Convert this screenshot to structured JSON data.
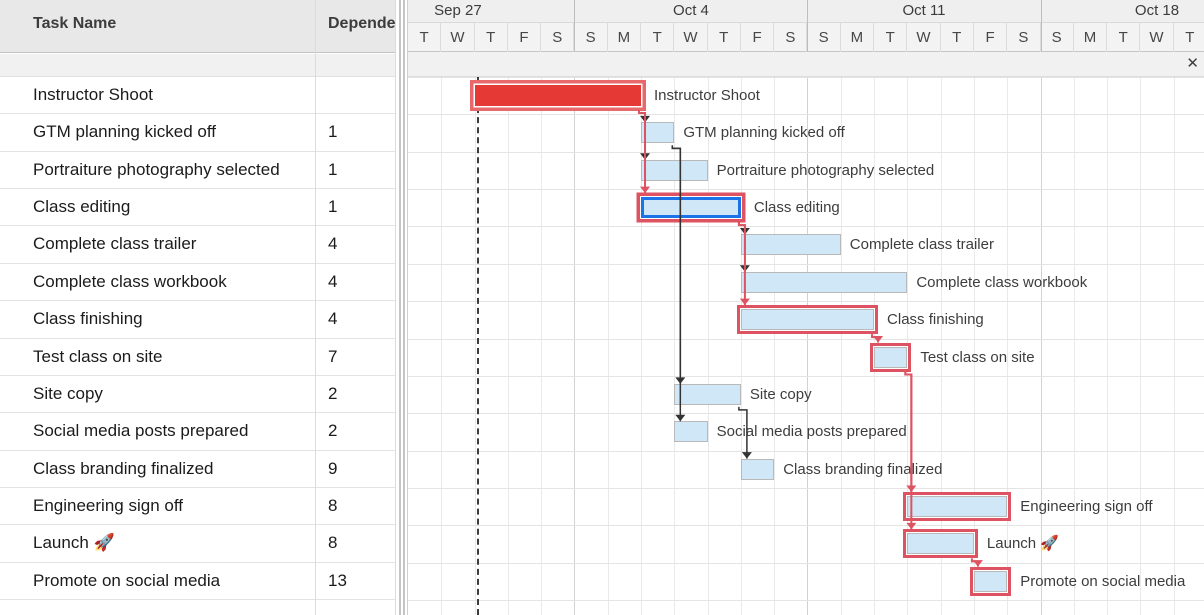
{
  "header": {
    "task_name_col": "Task Name",
    "dependencies_col": "Dependencies"
  },
  "timeline": {
    "weeks": [
      {
        "label": "Sep 27",
        "start_day": 0,
        "end_day": 5,
        "clipped": "left"
      },
      {
        "label": "Oct 4",
        "start_day": 5,
        "end_day": 12,
        "clipped": "none"
      },
      {
        "label": "Oct 11",
        "start_day": 12,
        "end_day": 19,
        "clipped": "none"
      },
      {
        "label": "Oct 18",
        "start_day": 19,
        "end_day": 24,
        "clipped": "right"
      }
    ],
    "day_letters": [
      "T",
      "W",
      "T",
      "F",
      "S",
      "S",
      "M",
      "T",
      "W",
      "T",
      "F",
      "S",
      "S",
      "M",
      "T",
      "W",
      "T",
      "F",
      "S",
      "S",
      "M",
      "T",
      "W",
      "T"
    ],
    "today_day_index": 2
  },
  "tasks": [
    {
      "id": 1,
      "name": "Instructor Shoot",
      "dependency": "",
      "start_day": 2,
      "duration_days": 5,
      "critical": true,
      "selected": false,
      "fill": "red"
    },
    {
      "id": 2,
      "name": "GTM planning kicked off",
      "dependency": "1",
      "start_day": 7,
      "duration_days": 1,
      "critical": false,
      "selected": false,
      "fill": "blue"
    },
    {
      "id": 3,
      "name": "Portraiture photography selected",
      "dependency": "1",
      "start_day": 7,
      "duration_days": 2,
      "critical": false,
      "selected": false,
      "fill": "blue"
    },
    {
      "id": 4,
      "name": "Class editing",
      "dependency": "1",
      "start_day": 7,
      "duration_days": 3,
      "critical": true,
      "selected": true,
      "fill": "blue"
    },
    {
      "id": 5,
      "name": "Complete class trailer",
      "dependency": "4",
      "start_day": 10,
      "duration_days": 3,
      "critical": false,
      "selected": false,
      "fill": "blue"
    },
    {
      "id": 6,
      "name": "Complete class workbook",
      "dependency": "4",
      "start_day": 10,
      "duration_days": 5,
      "critical": false,
      "selected": false,
      "fill": "blue"
    },
    {
      "id": 7,
      "name": "Class finishing",
      "dependency": "4",
      "start_day": 10,
      "duration_days": 4,
      "critical": true,
      "selected": false,
      "fill": "blue"
    },
    {
      "id": 8,
      "name": "Test class on site",
      "dependency": "7",
      "start_day": 14,
      "duration_days": 1,
      "critical": true,
      "selected": false,
      "fill": "blue"
    },
    {
      "id": 9,
      "name": "Site copy",
      "dependency": "2",
      "start_day": 8,
      "duration_days": 2,
      "critical": false,
      "selected": false,
      "fill": "blue"
    },
    {
      "id": 10,
      "name": "Social media posts prepared",
      "dependency": "2",
      "start_day": 8,
      "duration_days": 1,
      "critical": false,
      "selected": false,
      "fill": "blue"
    },
    {
      "id": 11,
      "name": "Class branding finalized",
      "dependency": "9",
      "start_day": 10,
      "duration_days": 1,
      "critical": false,
      "selected": false,
      "fill": "blue"
    },
    {
      "id": 12,
      "name": "Engineering sign off",
      "dependency": "8",
      "start_day": 15,
      "duration_days": 3,
      "critical": true,
      "selected": false,
      "fill": "blue"
    },
    {
      "id": 13,
      "name": "Launch 🚀",
      "dependency": "8",
      "start_day": 15,
      "duration_days": 2,
      "critical": true,
      "selected": false,
      "fill": "blue"
    },
    {
      "id": 14,
      "name": "Promote on social media",
      "dependency": "13",
      "start_day": 17,
      "duration_days": 1,
      "critical": true,
      "selected": false,
      "fill": "blue"
    }
  ],
  "close_button": "✕",
  "colors": {
    "critical_outline": "#dd5361",
    "critical_connector": "#dd5361",
    "normal_connector": "#333333",
    "bar_fill": "#cfe7f6",
    "bar_border": "#b9b9b9",
    "selected_border": "#1a73e8",
    "red_bar_fill": "#e53935",
    "red_bar_outline": "#e8696b",
    "today_line": "#3c3c3c"
  }
}
